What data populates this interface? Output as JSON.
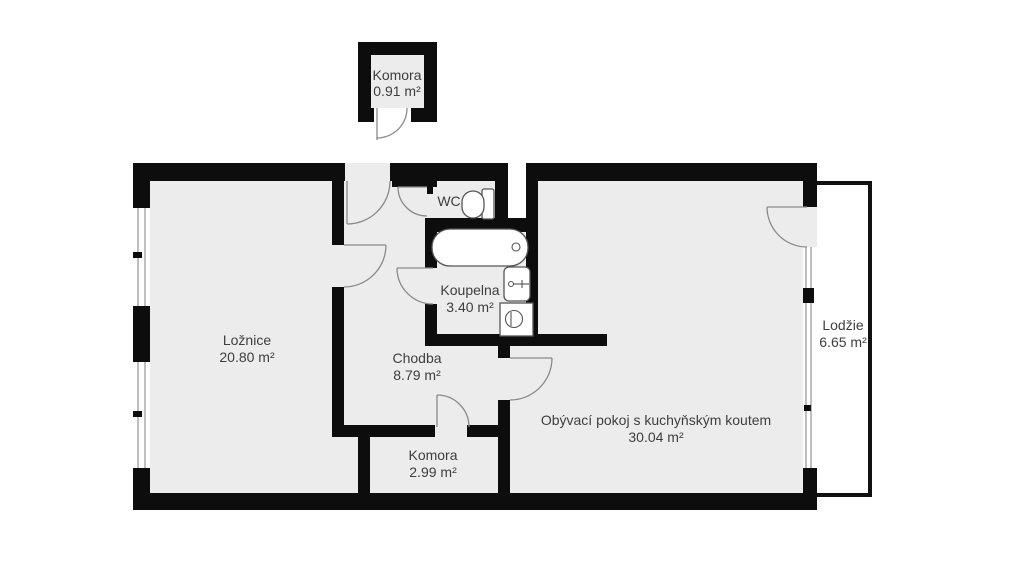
{
  "floor_plan": {
    "title": "Apartment floor plan",
    "rooms": [
      {
        "id": "komora-top",
        "name": "Komora",
        "area": "0.91 m²"
      },
      {
        "id": "wc",
        "name": "WC"
      },
      {
        "id": "koupelna",
        "name": "Koupelna",
        "area": "3.40 m²"
      },
      {
        "id": "loznice",
        "name": "Ložnice",
        "area": "20.80 m²"
      },
      {
        "id": "chodba",
        "name": "Chodba",
        "area": "8.79 m²"
      },
      {
        "id": "komora-bottom",
        "name": "Komora",
        "area": "2.99 m²"
      },
      {
        "id": "obyvaci-pokoj",
        "name": "Obývací pokoj s kuchyňským koutem",
        "area": "30.04 m²"
      },
      {
        "id": "lodzie",
        "name": "Lodžie",
        "area": "6.65 m²"
      }
    ],
    "fixtures": [
      "toilet",
      "bathtub",
      "sink",
      "washing-machine"
    ],
    "colors": {
      "wall": "#0d0d0d",
      "floor": "#ececec",
      "door_arc": "#8a8a8a",
      "fixture_outline": "#555555",
      "text": "#3e3e3e",
      "background": "#ffffff"
    }
  }
}
